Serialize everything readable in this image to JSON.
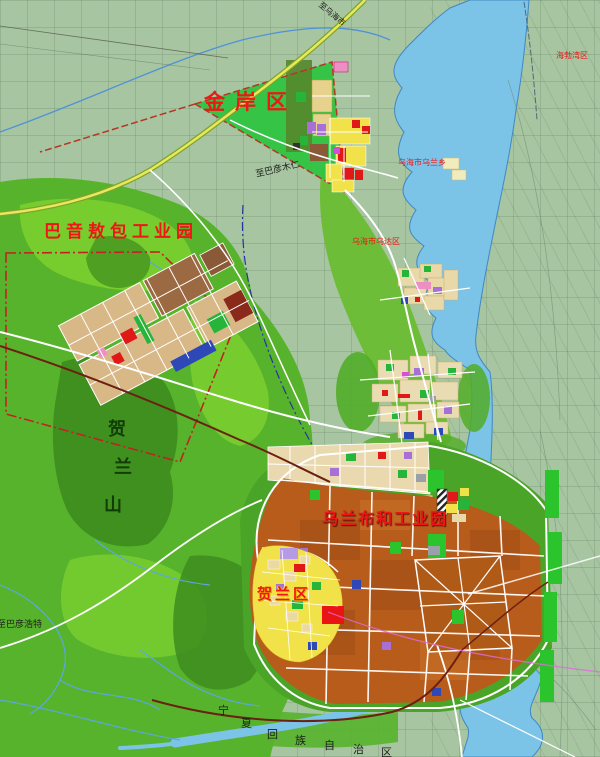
{
  "map": {
    "title": "regional land-use planning map",
    "labels": [
      {
        "id": "jinan-district-label",
        "text": "金岸区",
        "x": 204,
        "y": 92,
        "size": 21,
        "color": "label_red",
        "bold": true,
        "ls": 10
      },
      {
        "id": "bayin-aobao-park-label",
        "text": "巴音敖包工业园",
        "x": 44,
        "y": 224,
        "size": 17,
        "color": "label_red",
        "bold": true,
        "ls": 5
      },
      {
        "id": "wulanbuhe-park-label",
        "text": "乌兰布和工业园",
        "x": 322,
        "y": 511,
        "size": 16,
        "color": "label_red",
        "bold": true,
        "ls": 2,
        "glow": "dark"
      },
      {
        "id": "helan-district-label",
        "text": "贺兰区",
        "x": 257,
        "y": 587,
        "size": 15,
        "color": "label_red",
        "bold": true,
        "ls": 3,
        "glow": "gold"
      },
      {
        "id": "wuhai-wulan-town-label",
        "text": "乌海市乌兰乡",
        "x": 398,
        "y": 159,
        "size": 8,
        "color": "label_red"
      },
      {
        "id": "wuhai-wuda-district-label",
        "text": "乌海市乌达区",
        "x": 352,
        "y": 238,
        "size": 8,
        "color": "label_red"
      },
      {
        "id": "haibowan-label",
        "text": "海勃湾区",
        "x": 556,
        "y": 52,
        "size": 8,
        "color": "label_red"
      },
      {
        "id": "to-bayanmuren-label",
        "text": "至巴彦木仁",
        "x": 255,
        "y": 171,
        "size": 9,
        "color": "label_dark",
        "rot": -13
      },
      {
        "id": "to-wuhai-label",
        "text": "至乌海市",
        "x": 322,
        "y": 1,
        "size": 8,
        "color": "label_dark",
        "rot": 40
      },
      {
        "id": "to-bayanhaote-label",
        "text": "至巴彦浩特",
        "x": -3,
        "y": 621,
        "size": 9,
        "color": "label_dark"
      },
      {
        "id": "helan-mountain-char-1",
        "text": "贺",
        "x": 108,
        "y": 421,
        "size": 18,
        "color": "mountain_label",
        "bold": true
      },
      {
        "id": "helan-mountain-char-2",
        "text": "兰",
        "x": 114,
        "y": 459,
        "size": 18,
        "color": "mountain_label",
        "bold": true
      },
      {
        "id": "helan-mountain-char-3",
        "text": "山",
        "x": 104,
        "y": 497,
        "size": 18,
        "color": "mountain_label",
        "bold": true
      },
      {
        "id": "ningxia-boundary-char-1",
        "text": "宁",
        "x": 218,
        "y": 705,
        "size": 11,
        "color": "label_dark"
      },
      {
        "id": "ningxia-boundary-char-2",
        "text": "夏",
        "x": 241,
        "y": 718,
        "size": 11,
        "color": "label_dark"
      },
      {
        "id": "ningxia-boundary-char-3",
        "text": "回",
        "x": 267,
        "y": 729,
        "size": 11,
        "color": "label_dark"
      },
      {
        "id": "ningxia-boundary-char-4",
        "text": "族",
        "x": 295,
        "y": 735,
        "size": 11,
        "color": "label_dark"
      },
      {
        "id": "ningxia-boundary-char-5",
        "text": "自",
        "x": 324,
        "y": 740,
        "size": 11,
        "color": "label_dark"
      },
      {
        "id": "ningxia-boundary-char-6",
        "text": "治",
        "x": 353,
        "y": 744,
        "size": 11,
        "color": "label_dark"
      },
      {
        "id": "ningxia-boundary-char-7",
        "text": "区",
        "x": 381,
        "y": 747,
        "size": 11,
        "color": "label_dark"
      }
    ]
  },
  "colors": {
    "base": "#a6c5a0",
    "terrain": "#58b32c",
    "terrain_light": "#7bcf2f",
    "terrain_dark": "#3d8c1e",
    "water": "#7cc3e8",
    "water_edge": "#3f88c4",
    "road": "#ffffff",
    "highway_fill": "#e8e85a",
    "highway_casing": "#7da32f",
    "rail": "#6b2012",
    "boundary_red": "#b83526",
    "boundary_blue": "#23359c",
    "power_line": "#e26ad8",
    "zone_green": "#2ec440",
    "tan": "#d9b887",
    "tan_light": "#ead9ae",
    "orange": "#b85c1c",
    "orange_dark": "#a14e16",
    "yellow": "#f2e24a",
    "red": "#e01818",
    "purple": "#a86fd6",
    "blue_block": "#2e48b8",
    "green_block": "#27b43a",
    "gray_block": "#9aa0a8",
    "pink": "#ee8fc3",
    "brown": "#8a5a38",
    "label_red": "#ee1616",
    "label_dark": "#1c1c1c",
    "mountain_label": "#123c08"
  }
}
